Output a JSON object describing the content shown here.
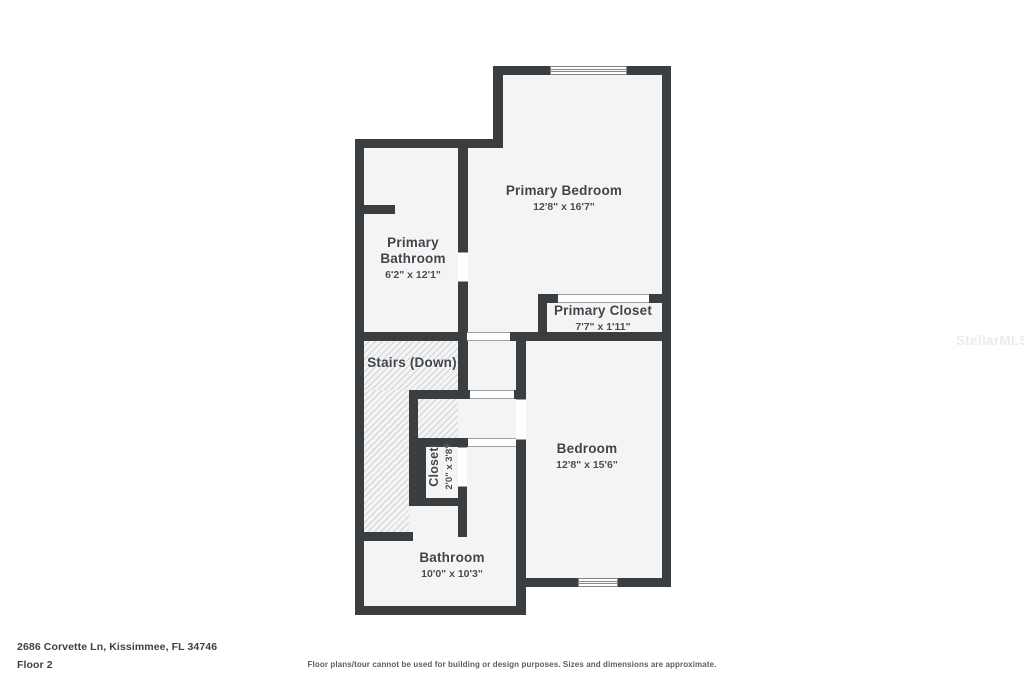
{
  "plan": {
    "rooms": {
      "primary_bedroom": {
        "name": "Primary Bedroom",
        "dims": "12'8\" x 16'7\""
      },
      "primary_bathroom": {
        "name": "Primary Bathroom",
        "dims": "6'2\" x 12'1\""
      },
      "primary_closet": {
        "name": "Primary Closet",
        "dims": "7'7\" x 1'11\""
      },
      "stairs": {
        "name": "Stairs (Down)"
      },
      "closet": {
        "name": "Closet",
        "dims": "2'0\" x 3'8\""
      },
      "bedroom": {
        "name": "Bedroom",
        "dims": "12'8\" x 15'6\""
      },
      "bathroom": {
        "name": "Bathroom",
        "dims": "10'0\" x 10'3\""
      }
    },
    "colors": {
      "wall": "#3b3e41",
      "room_fill": "#f4f4f5",
      "hatch_line": "#cfd2d4",
      "label_text": "#3f454b"
    }
  },
  "footer": {
    "address": "2686 Corvette Ln, Kissimmee, FL 34746",
    "floor": "Floor 2",
    "disclaimer": "Floor plans/tour cannot be used for building or design purposes. Sizes and dimensions are approximate."
  },
  "watermark": "StellarMLS"
}
